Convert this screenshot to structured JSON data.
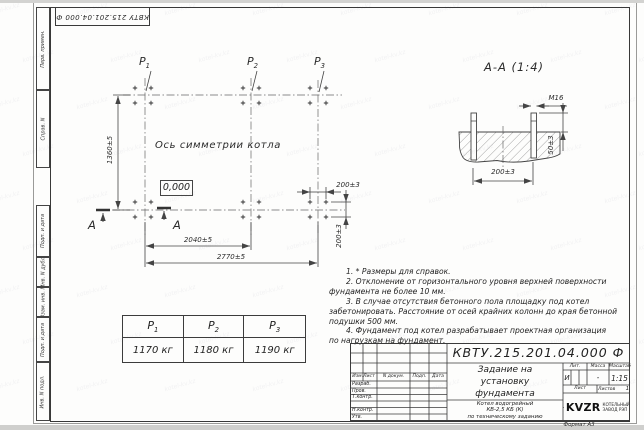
{
  "watermark_text": "kotel-kv.kz",
  "stamp_top": {
    "text": "КВТУ 215.201.04.000 Ф"
  },
  "side_strip": {
    "labels": [
      "Перв. примен.",
      "Справ. N",
      "Подп. и дата",
      "Инв. N дубл.",
      "Взам. инв. N",
      "Подп. и дата",
      "Инв. N подл."
    ]
  },
  "plan": {
    "labels": [
      {
        "base": "P",
        "sub": "1"
      },
      {
        "base": "P",
        "sub": "2"
      },
      {
        "base": "P",
        "sub": "3"
      }
    ],
    "axis_label": "Ось симметрии котла",
    "elevation": "0,000",
    "dim_height": "1360±5",
    "dim_width_inner": "2040±5",
    "dim_width_outer": "2770±5",
    "dim_bolt_h": "200±3",
    "dim_bolt_v": "200±3",
    "section_letter_left": "А",
    "section_letter_right": "А"
  },
  "section": {
    "title": "А-А (1:4)",
    "thread": "M16",
    "dim_protrusion": "50±3",
    "dim_spacing": "200±3"
  },
  "loads_table": {
    "headers": [
      {
        "base": "P",
        "sub": "1"
      },
      {
        "base": "P",
        "sub": "2"
      },
      {
        "base": "P",
        "sub": "3"
      }
    ],
    "values": [
      "1170 кг",
      "1180 кг",
      "1190 кг"
    ]
  },
  "notes": {
    "lines": [
      {
        "t": "1. * Размеры для справок."
      },
      {
        "t": "2. Отклонение от горизонтального уровня верхней поверхности"
      },
      {
        "t": "фундамента не более 10 мм."
      },
      {
        "t": "3. В случае отсутствия бетонного пола площадку под котел"
      },
      {
        "t": "забетонировать. Расстояние от осей крайних колонн до края бетонной"
      },
      {
        "t": "подушки 500 мм."
      },
      {
        "t": "4. Фундамент под котел разрабатывает проектная организация"
      },
      {
        "t": "по нагрузкам на фундамент."
      }
    ]
  },
  "title_block": {
    "doc_number": "КВТУ.215.201.04.000 Ф",
    "rev_headers": [
      "Изм.Лист",
      "N докум.",
      "Подп.",
      "Дата"
    ],
    "roles": [
      "Разраб.",
      "Пров.",
      "Т.контр.",
      "Н.контр.",
      "Утв."
    ],
    "title_lines": [
      "Задание на",
      "установку",
      "фундамента"
    ],
    "product_lines": [
      "Котел водогрейный",
      "КВ-2,5 КБ (К)",
      "по техническому заданию"
    ],
    "lit_label": "Лит.",
    "mass_label": "Масса",
    "scale_label": "Масштаб",
    "lit_value": "И",
    "mass_value": "-",
    "scale_value": "1:15",
    "sheet_label": "Лист",
    "sheets_label": "Листов",
    "sheets_value": "1",
    "logo_text": "KVZR",
    "company_lines": [
      "КОТЕЛЬНЫЙ",
      "ЗАВОД РЭП"
    ],
    "format_label": "Формат А3"
  }
}
